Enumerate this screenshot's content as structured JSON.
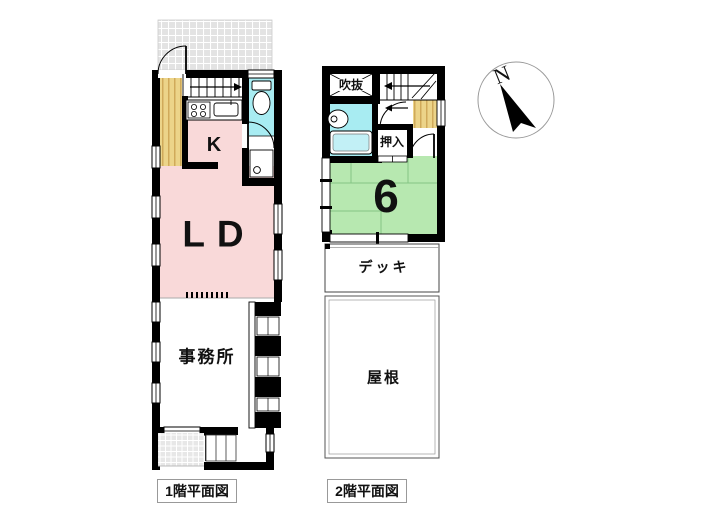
{
  "floor1": {
    "caption": "1階平面図",
    "rooms": {
      "kitchen": "K",
      "living_dining": "LD",
      "office": "事務所"
    }
  },
  "floor2": {
    "caption": "2階平面図",
    "rooms": {
      "void": "吹抜",
      "closet": "押入",
      "tatami": "6",
      "deck": "デッキ",
      "roof": "屋根"
    }
  },
  "compass": {
    "north": "N"
  },
  "colors": {
    "wall": "#000000",
    "room_pink": "#f9d9d9",
    "water_cyan": "#a8ecf2",
    "tatami_green": "#b7e8b0",
    "tatami_line": "#84c584",
    "wood_yellow": "#ecd489",
    "wood_stripe": "#c9a04e",
    "hatch_gray": "#e3e3e3"
  }
}
